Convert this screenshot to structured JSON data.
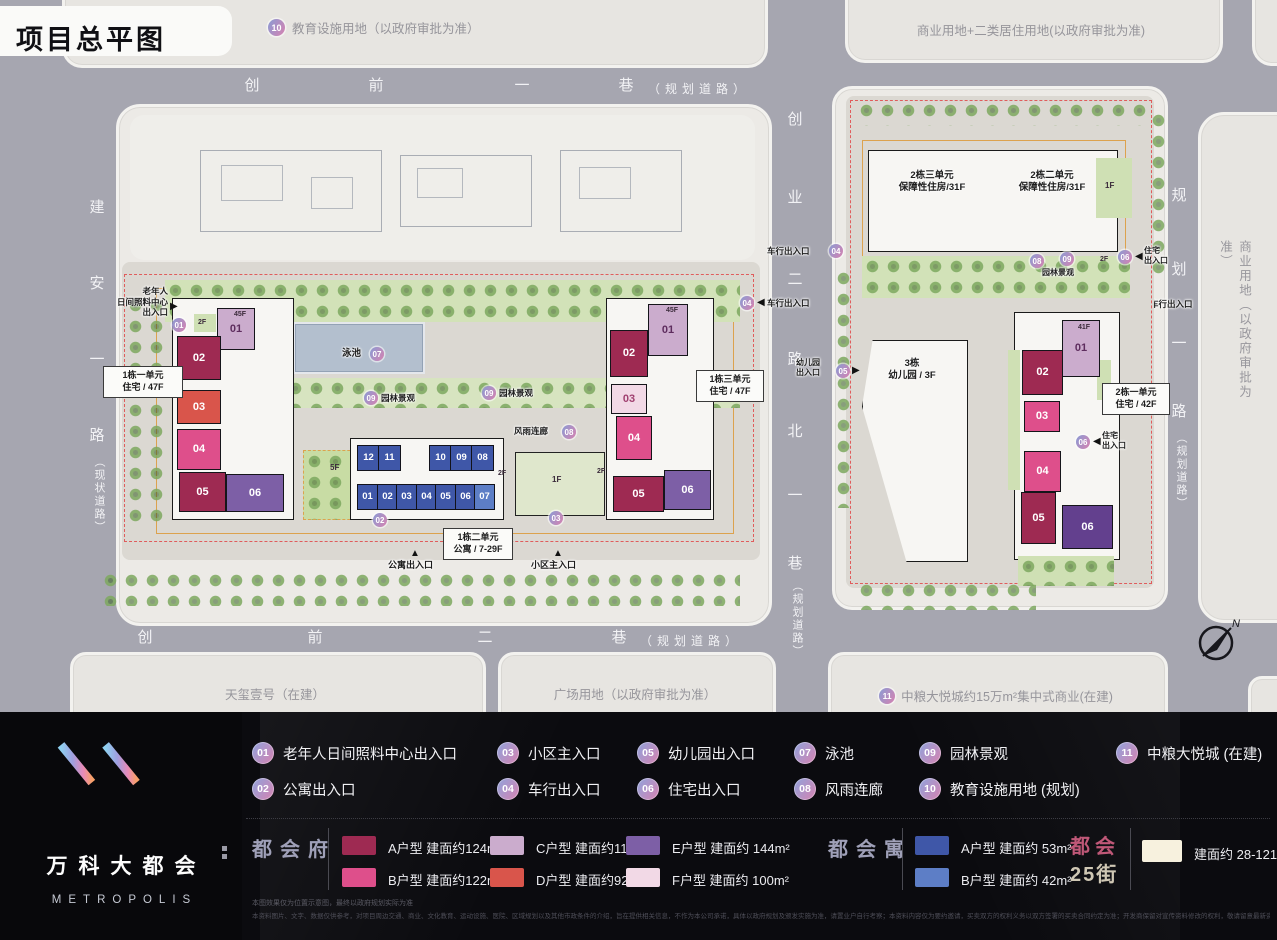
{
  "title": "项目总平图",
  "palette": {
    "typeA": "#9e2a52",
    "typeB": "#de4f8b",
    "typeC": "#cbaccd",
    "typeD": "#d9554b",
    "typeE": "#7d5fa6",
    "typeE2": "#63408e",
    "typeF": "#f2d9e6",
    "yuA": "#3f57a8",
    "yuB": "#5d7ec6",
    "street": "#f7f1de"
  },
  "icons": {
    "arrow_right": "▶",
    "arrow_left": "◀",
    "arrow_up": "▲"
  },
  "compass_n": "N",
  "parcels": {
    "top_left_badge": "10",
    "top_left": "教育设施用地（以政府审批为准）",
    "top_right": "商业用地+二类居住用地(以政府审批为准)",
    "east_commercial": "商业用地（以政府审批为准）",
    "upper_block": "天玺壹号（在建）",
    "bottom_left": "天玺壹号（在建）",
    "bottom_mid": "广场用地（以政府审批为准）",
    "bottom_right_badge": "11",
    "bottom_right": "中粮大悦城约15万m²集中式商业(在建)"
  },
  "roads": {
    "north": {
      "c1": "创",
      "c2": "前",
      "c3": "一",
      "c4": "巷",
      "suffix": "（规划道路）"
    },
    "south": {
      "c1": "创",
      "c2": "前",
      "c3": "二",
      "c4": "巷",
      "suffix": "（规划道路）"
    },
    "west": {
      "c1": "建",
      "c2": "安",
      "c3": "一",
      "c4": "路",
      "suffix": "（现状道路）"
    },
    "east": {
      "c1": "规",
      "c2": "划",
      "c3": "一",
      "c4": "路",
      "suffix": "（规划道路）"
    },
    "mid": {
      "c1": "创",
      "c2": "业",
      "c3": "二",
      "c4": "路",
      "c5": "北",
      "c6": "一",
      "c7": "巷",
      "suffix": "（规划道路）"
    }
  },
  "left_site": {
    "elder1": "老年人",
    "elder2": "日间照料中心",
    "elder3": "出入口",
    "elder_badge": "01",
    "t1u1_l1": "1栋一单元",
    "t1u1_l2": "住宅 / 47F",
    "t1u3_l1": "1栋三单元",
    "t1u3_l2": "住宅 / 47F",
    "t1u2_l1": "1栋二单元",
    "t1u2_l2": "公寓 / 7-29F",
    "pool_label": "泳池",
    "pool_badge": "07",
    "garden_label": "园林景观",
    "garden_badge": "09",
    "corridor_label": "风雨连廊",
    "corridor_badge": "08",
    "apt_exit": "公寓出入口",
    "main_entry": "小区主入口",
    "badge02": "02",
    "badge03": "03",
    "west_units": [
      "01",
      "02",
      "03",
      "04",
      "05",
      "06"
    ],
    "east_units": [
      "01",
      "02",
      "03",
      "04",
      "05",
      "06"
    ],
    "apt_top": [
      "12",
      "11",
      "10",
      "09",
      "08"
    ],
    "apt_bottom": [
      "01",
      "02",
      "03",
      "04",
      "05",
      "06",
      "07"
    ],
    "f45": "45F",
    "f2": "2F",
    "f5": "5F",
    "f1": "1F"
  },
  "right_site": {
    "bao1_l1": "2栋三单元",
    "bao1_l2": "保障性住房/31F",
    "bao2_l1": "2栋二单元",
    "bao2_l2": "保障性住房/31F",
    "kg_l1": "3栋",
    "kg_l2": "幼儿园 / 3F",
    "kg_exit1": "幼儿园",
    "kg_exit2": "出入口",
    "kg_badge": "05",
    "t2u1_l1": "2栋一单元",
    "t2u1_l2": "住宅 / 42F",
    "res_exit1": "住宅",
    "res_exit2": "出入口",
    "res_badge": "06",
    "units": [
      "01",
      "02",
      "03",
      "04",
      "05",
      "06"
    ],
    "f41": "41F",
    "f1": "1F",
    "f2": "2F",
    "garden_label": "园林景观",
    "garden_badge": "09",
    "corridor_badge": "08"
  },
  "entrances": {
    "vehicle": "车行出入口",
    "vehicle_badge": "04"
  },
  "legend": [
    {
      "n": "01",
      "label": "老年人日间照料中心出入口"
    },
    {
      "n": "02",
      "label": "公寓出入口"
    },
    {
      "n": "03",
      "label": "小区主入口"
    },
    {
      "n": "04",
      "label": "车行出入口"
    },
    {
      "n": "05",
      "label": "幼儿园出入口"
    },
    {
      "n": "06",
      "label": "住宅出入口"
    },
    {
      "n": "07",
      "label": "泳池"
    },
    {
      "n": "08",
      "label": "风雨连廊"
    },
    {
      "n": "09",
      "label": "园林景观"
    },
    {
      "n": "10",
      "label": "教育设施用地 (规划)"
    },
    {
      "n": "11",
      "label": "中粮大悦城 (在建)"
    }
  ],
  "types": {
    "fu_title": "都会府",
    "fu": [
      {
        "label": "A户型 建面约124m²"
      },
      {
        "label": "B户型 建面约122m²"
      },
      {
        "label": "C户型 建面约115m²"
      },
      {
        "label": "D户型 建面约92m²"
      },
      {
        "label": "E户型 建面约 144m²"
      },
      {
        "label": "F户型 建面约 100m²"
      }
    ],
    "yu_title": "都会寓",
    "yu": [
      {
        "label": "A户型 建面约 53m²"
      },
      {
        "label": "B户型 建面约 42m²"
      }
    ],
    "street_title_1": "都会",
    "street_title_2": "25街",
    "street_label": "建面约 28-121m²"
  },
  "logo": {
    "cn": "万科大都会",
    "en": "METROPOLIS"
  },
  "disclaimer1": "本图效果仅为位置示意图，最终以政府规划实际为准",
  "disclaimer2": "本资料图片、文字、数据仅供参考，对项目周边交通、商业、文化教育、运动设施、医院、区域规划以及其他市政条件的介绍，旨在提供相关信息，不作为本公司承诺，具体以政府规划及颁发实施为准，请置业户自行考察；本资料内容仅为要约邀请，买卖双方的权利义务以双方签署的买卖合同约定为准；开发商保留对宣传资料修改的权利，敬请留意最新资料；备案号：万科大都会项目"
}
